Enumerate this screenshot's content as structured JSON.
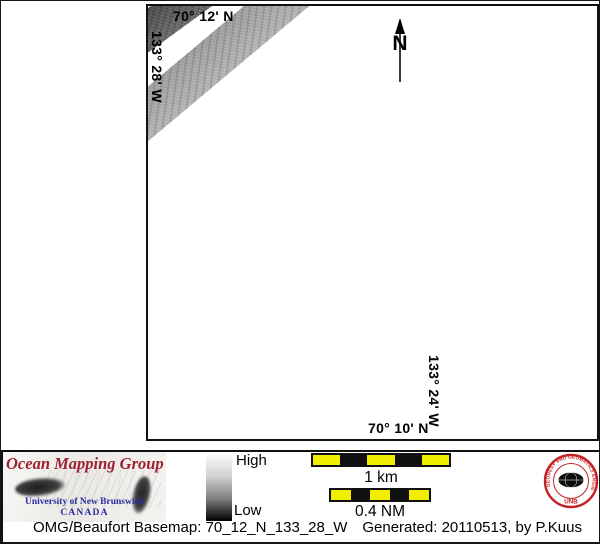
{
  "map": {
    "top_latitude_label": "70° 12' N",
    "left_longitude_label": "133° 28' W",
    "right_longitude_label": "133° 24' W",
    "bottom_latitude_label": "70° 10' N",
    "north_arrow_label": "N"
  },
  "legend": {
    "colorbar_high_label": "High",
    "colorbar_low_label": "Low",
    "scalebar_km_label": "1 km",
    "scalebar_nm_label": "0.4 NM"
  },
  "logos": {
    "omg_title": "Ocean Mapping Group",
    "omg_institution": "University of New Brunswick",
    "omg_country": "CANADA",
    "unb_seal_ring_text": "GEODESY AND GEOMATICS ENGINEERING",
    "unb_seal_acronym": "UNB"
  },
  "footer": {
    "basemap_label": "OMG/Beaufort Basemap: 70_12_N_133_28_W",
    "generated_label": "Generated: 20110513, by P.Kuus"
  },
  "colors": {
    "scalebar_yellow": "#f2ee00",
    "omg_title_red": "#9e2033",
    "unb_text_blue": "#2b2ba0",
    "seal_red": "#c42222",
    "swath_dark_gray": "#5a5a5a",
    "swath_light_gray": "#a7a7a7"
  }
}
